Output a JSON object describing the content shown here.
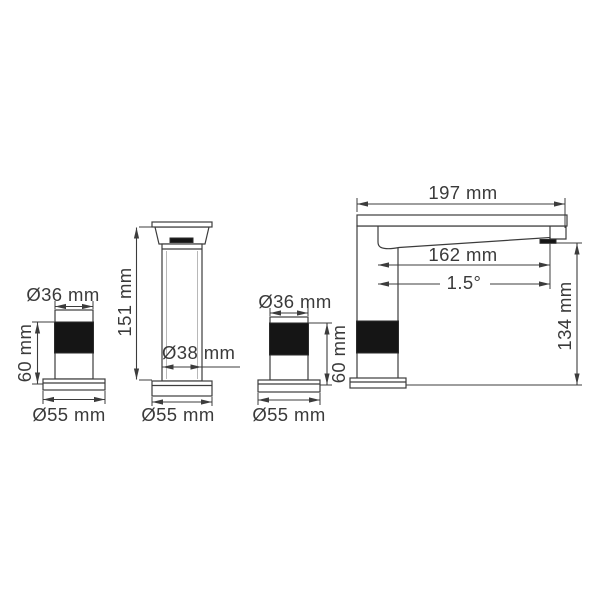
{
  "drawing": {
    "type": "technical-dimension-drawing",
    "subject": "basin faucet with two handles (front and side views)",
    "colors": {
      "background": "#ffffff",
      "line": "#3c3c3c",
      "solid_fill": "#151515",
      "text": "#3a3a3a"
    },
    "labels": {
      "handle_left": {
        "top_diameter": "Ø36 mm",
        "side_height": "60 mm",
        "base_diameter": "Ø55 mm"
      },
      "spout_front": {
        "height": "151 mm",
        "body_diameter": "Ø38 mm",
        "base_diameter": "Ø55 mm"
      },
      "handle_right": {
        "top_diameter": "Ø36 mm",
        "side_height": "60 mm",
        "base_diameter": "Ø55 mm"
      },
      "spout_side": {
        "total_length": "197 mm",
        "spout_reach": "162 mm",
        "spout_angle": "1.5°",
        "total_height": "134 mm"
      }
    }
  }
}
